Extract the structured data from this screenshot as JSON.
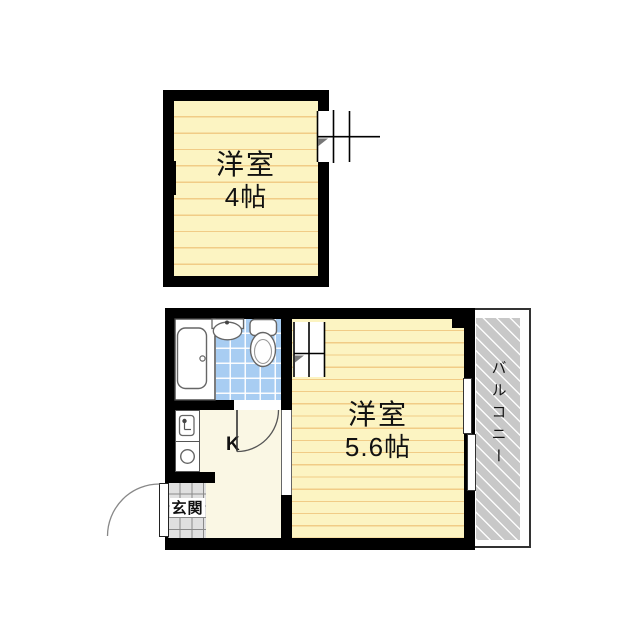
{
  "floorplan": {
    "upper_room": {
      "label": "洋室",
      "size": "4帖"
    },
    "lower_room": {
      "label": "洋室",
      "size": "5.6帖"
    },
    "kitchen": {
      "label": "K"
    },
    "entrance": {
      "label": "玄関"
    },
    "balcony": {
      "label": "バルコニー"
    },
    "colors": {
      "wall": "#000000",
      "room_floor": "#FCF4C2",
      "floor_stripe": "#F1CC86",
      "kitchen_floor": "#FAF7E4",
      "bathroom_tile": "#A8CDF2",
      "entrance_tile": "#E0E0E0",
      "balcony_hatch": "#C8C8C8"
    }
  }
}
